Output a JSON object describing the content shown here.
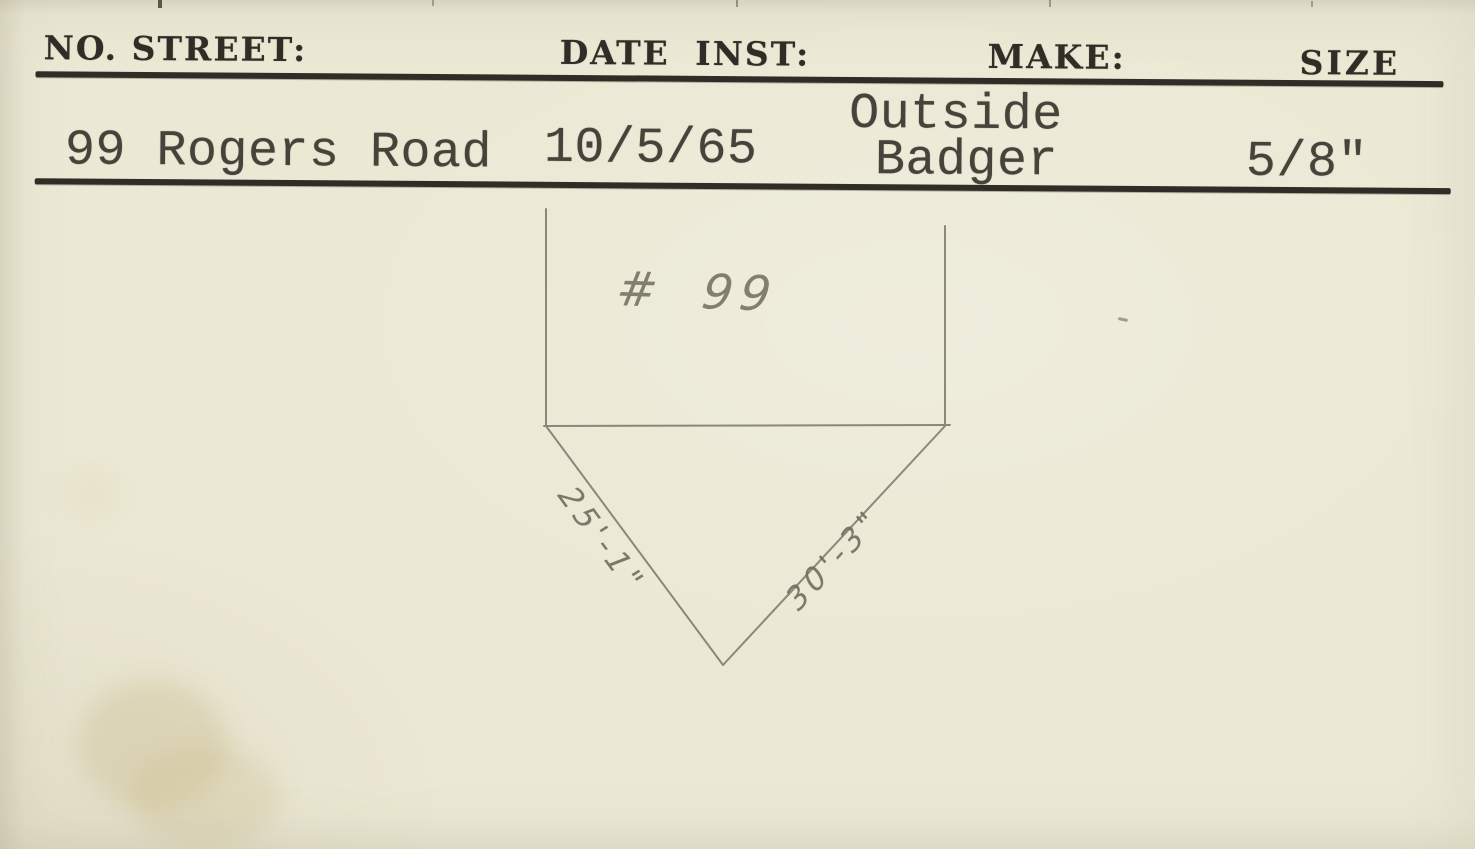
{
  "colors": {
    "paper": "#ebe8d4",
    "ink": "#2f2d26",
    "type_ink": "#46443a",
    "pencil": "#6f6d5c",
    "stain": "rgba(199,182,134,0.32)"
  },
  "header": {
    "no_street_label": "NO. STREET:",
    "date_inst_label": "DATE INST:",
    "make_label": "MAKE:",
    "size_label": "SIZE"
  },
  "record": {
    "street": "99 Rogers Road",
    "date_installed": "10/5/65",
    "make_location": "Outside",
    "make_brand": "Badger",
    "size": "5/8\""
  },
  "sketch": {
    "house_number": "# 99",
    "left_side_dimension": "25'-1\"",
    "right_side_dimension": "30'-3\""
  }
}
